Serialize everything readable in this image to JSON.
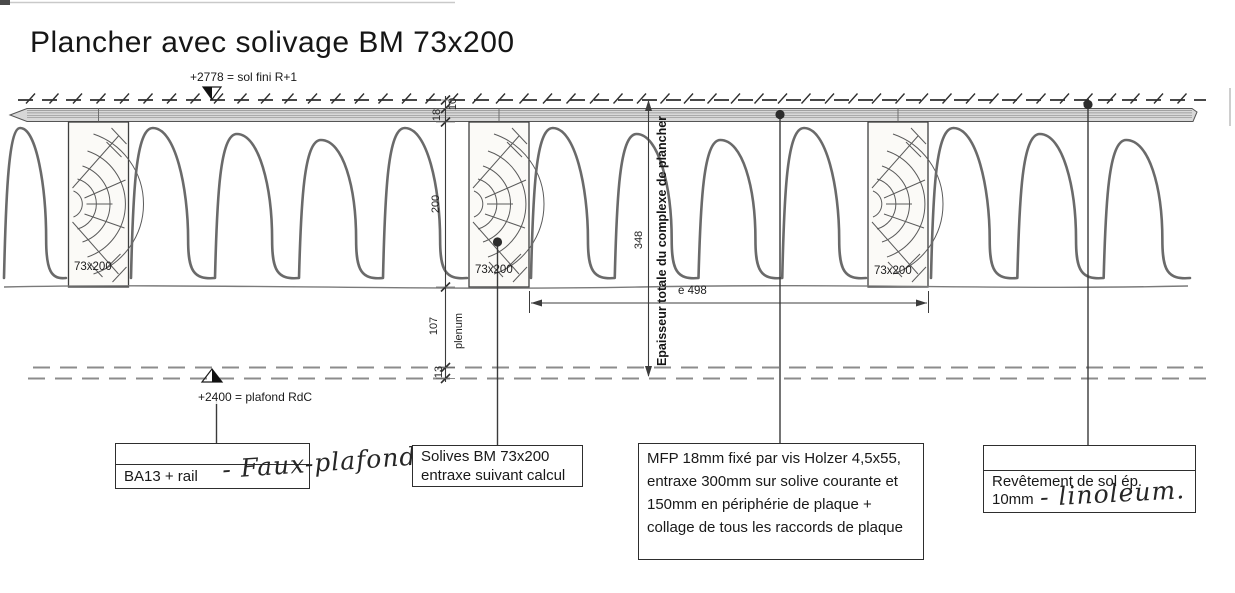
{
  "title": "Plancher avec solivage BM 73x200",
  "levels": {
    "top": "+2778 = sol fini R+1",
    "bottom": "+2400 = plafond RdC"
  },
  "dims": {
    "covering": "10",
    "board": "18",
    "joist_height": "200",
    "total": "348",
    "plenum": "107",
    "plenum_word": "plenum",
    "ceiling": "13",
    "spacing": "e 498",
    "total_note": "Epaisseur totale du complexe de plancher"
  },
  "joists": {
    "label": "73x200"
  },
  "callouts": {
    "ceiling_box": {
      "printed": "BA13 + rail",
      "handwritten": "- Faux-plafond."
    },
    "joists_box": {
      "line1": "Solives BM 73x200",
      "line2": "entraxe suivant calcul"
    },
    "mfp_box": {
      "text": "MFP 18mm fixé par vis Holzer 4,5x55, entraxe 300mm sur solive courante et 150mm en périphérie de plaque + collage de tous les raccords de plaque"
    },
    "floor_box": {
      "line1": "Revêtement de sol ép.",
      "line2": "10mm",
      "handwritten": "- linoleum."
    }
  },
  "colors": {
    "ink": "#1d1d1d",
    "line": "#3c3c3c",
    "grain": "#5a5a5a",
    "insulation": "#6a6a6a",
    "mfp_fill": "#d8d8d8",
    "paper": "#ffffff"
  }
}
